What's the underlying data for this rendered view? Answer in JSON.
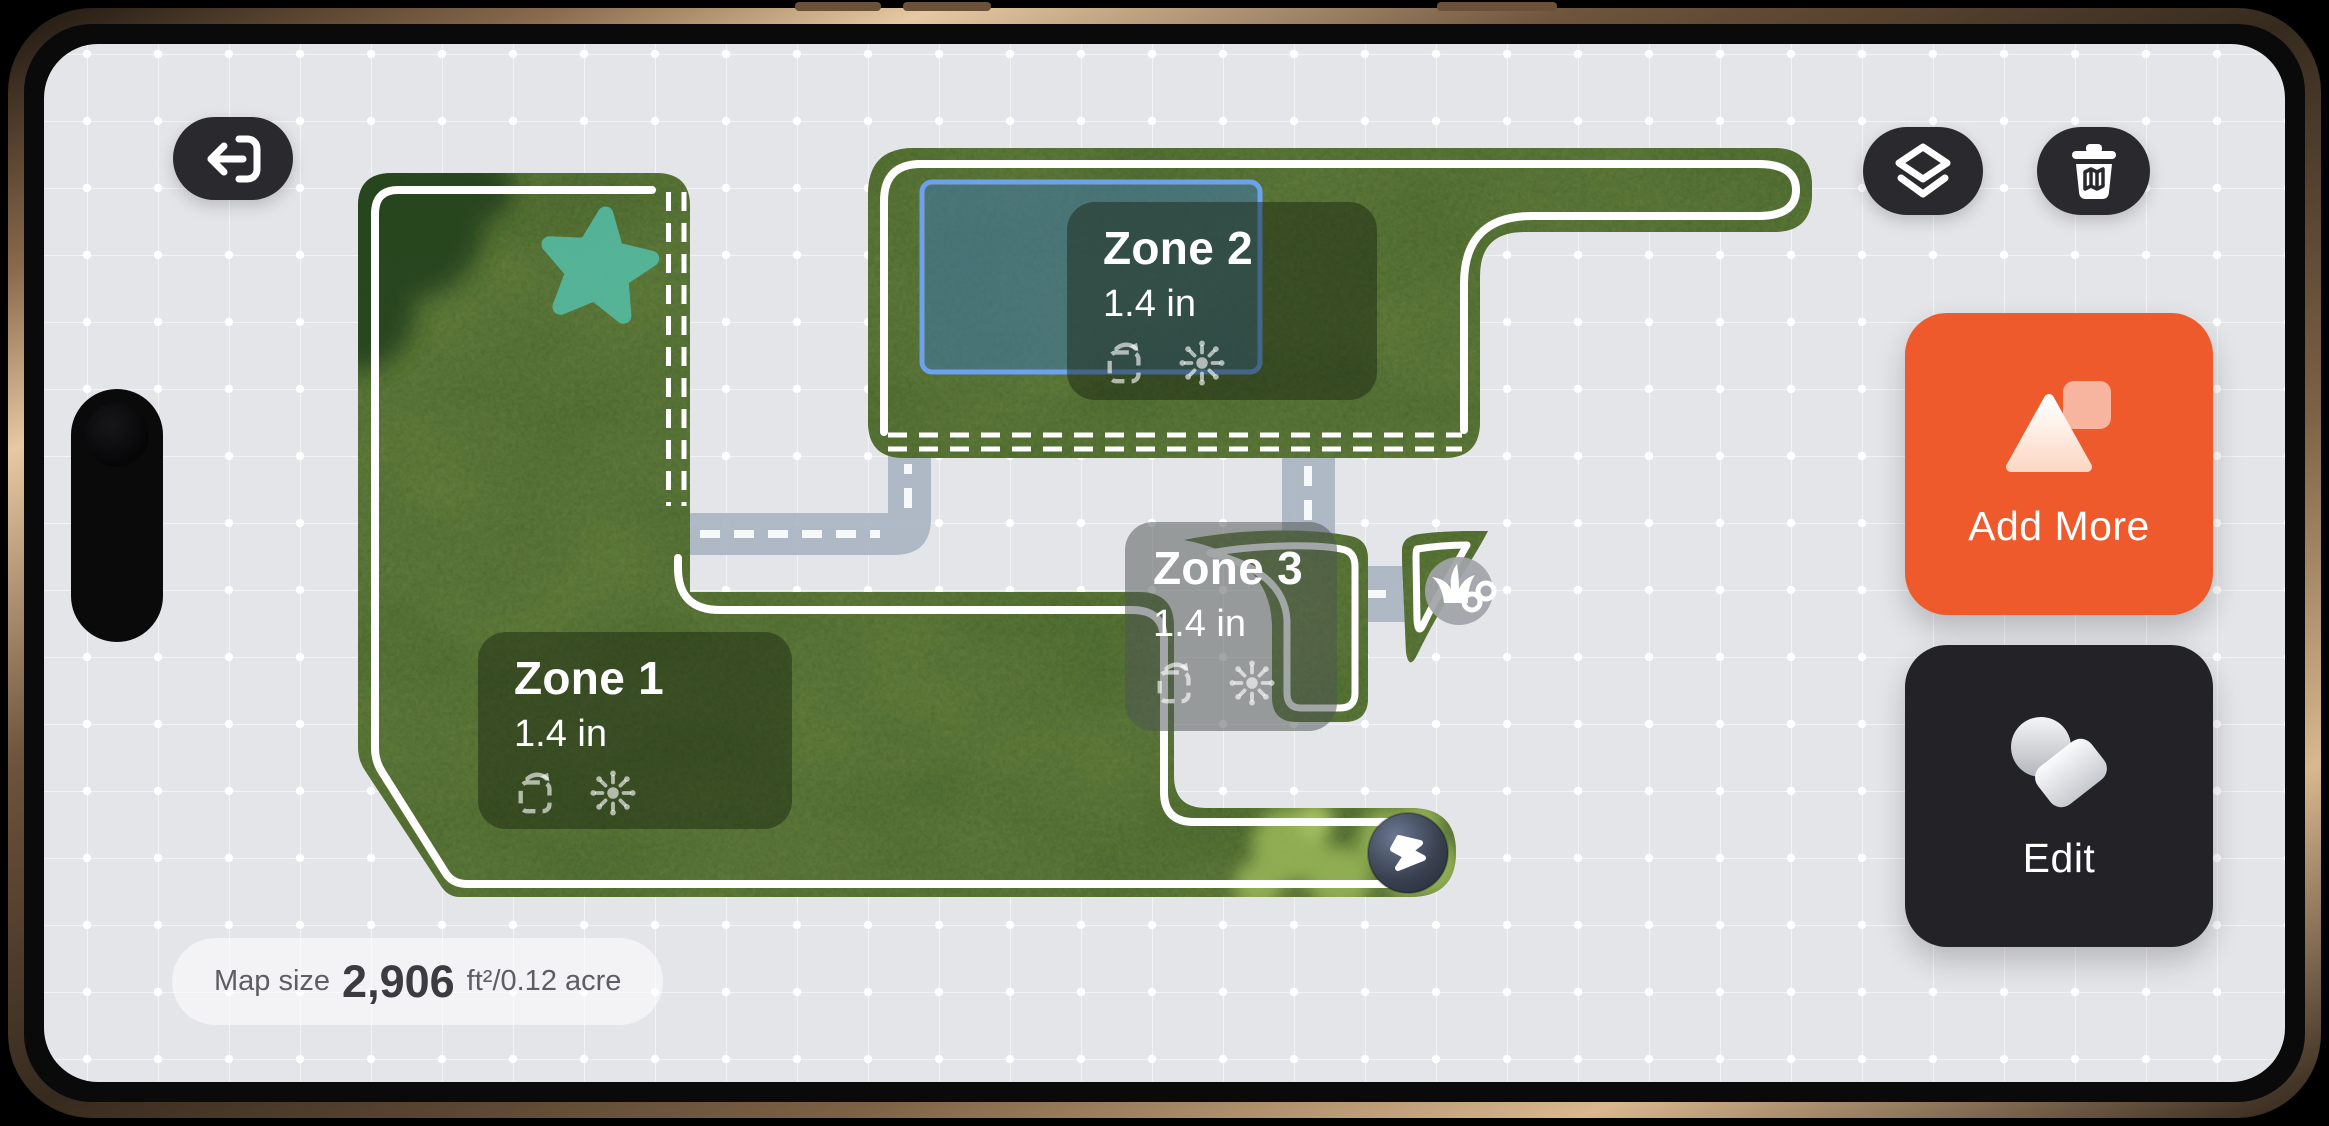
{
  "map": {
    "zones": [
      {
        "name": "Zone 1",
        "height": "1.4 in",
        "selected": false
      },
      {
        "name": "Zone 2",
        "height": "1.4 in",
        "selected": true
      },
      {
        "name": "Zone 3",
        "height": "1.4 in",
        "selected": false
      }
    ],
    "size_pill": {
      "label": "Map size",
      "area": "2,906",
      "units": "ft²/0.12 acre"
    },
    "markers": [
      {
        "name": "favorite-star-marker",
        "color": "#55BAA1"
      },
      {
        "name": "charging-dock-marker",
        "icon": "lightning-bolt-icon"
      },
      {
        "name": "grass-link-badge",
        "icon": "grass-link-icon"
      }
    ],
    "colors": {
      "screen_background": "#E4E5E9",
      "grass": "#67813E",
      "corridor": "#A9B4C1",
      "boundary": "#FFFFFF",
      "selection_blue": "#6BA1F0"
    }
  },
  "toolbar": {
    "back_button": {
      "icon": "exit-left-icon"
    },
    "layers_button": {
      "icon": "layers-icon"
    },
    "delete_button": {
      "icon": "trash-map-icon"
    }
  },
  "actions": {
    "add_more": {
      "label": "Add More",
      "color": "#EE5A2B",
      "icon": "add-zone-icon"
    },
    "edit": {
      "label": "Edit",
      "color": "#232327",
      "icon": "edit-shapes-icon"
    }
  }
}
